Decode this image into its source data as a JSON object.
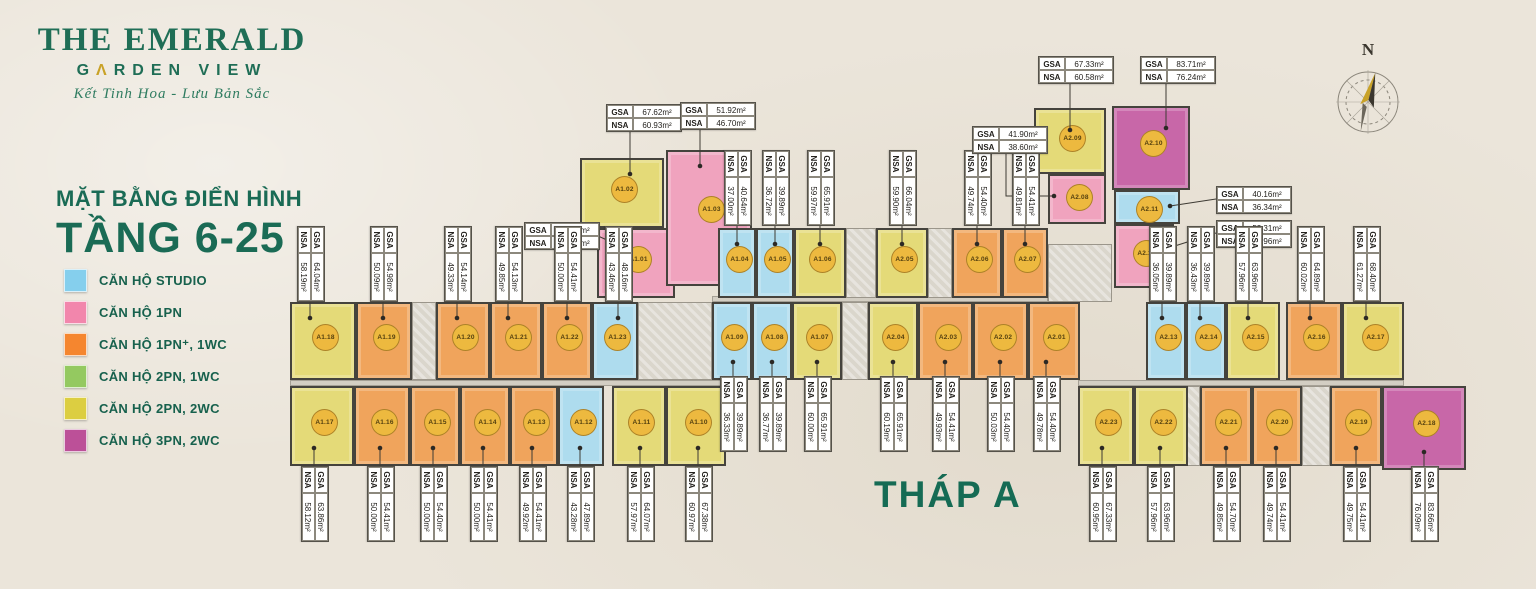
{
  "branding": {
    "line1": "THE EMERALD",
    "line2_pre": "G",
    "line2_accent": "Λ",
    "line2_rest": "RDEN VIEW",
    "tagline": "Kết Tinh Hoa - Lưu Bản Sắc"
  },
  "heading": {
    "line1": "MẶT BẰNG  ĐIỂN HÌNH",
    "line2": "TẦNG 6-25"
  },
  "tower_label": "THÁP A",
  "compass_letter": "N",
  "area_labels": {
    "gsa": "GSA",
    "nsa": "NSA"
  },
  "colors": {
    "wall": "#45433D",
    "badge": "#EDB93F",
    "leader": "#3E3B34",
    "fills": {
      "studio": "#AEDCEE",
      "pn1": "#F0A3BE",
      "pn1p": "#F0A45C",
      "pn2_1wc": "#A5CE6F",
      "pn2_2wc": "#E4DA78",
      "pn3_2wc": "#C867A8"
    }
  },
  "legend": [
    {
      "type": "studio",
      "color": "#85CFED",
      "label": "CĂN HỘ STUDIO"
    },
    {
      "type": "pn1",
      "color": "#F286AC",
      "label": "CĂN HỘ 1PN"
    },
    {
      "type": "pn1p",
      "color": "#F5862F",
      "label": "CĂN HỘ 1PN⁺, 1WC"
    },
    {
      "type": "pn2_1wc",
      "color": "#94C960",
      "label": "CĂN HỘ 2PN, 1WC"
    },
    {
      "type": "pn2_2wc",
      "color": "#DCCE41",
      "label": "CĂN HỘ 2PN, 2WC"
    },
    {
      "type": "pn3_2wc",
      "color": "#BC5098",
      "label": "CĂN HỘ 3PN, 2WC"
    }
  ],
  "units": [
    {
      "id": "A1.01",
      "type": "pn1",
      "x": 597,
      "y": 228,
      "w": 78,
      "h": 70,
      "gsa": "52.31m²",
      "nsa": "46.87m²",
      "label": {
        "kind": "h",
        "bx": 524,
        "by": 222,
        "leader": [
          [
            598,
            236
          ],
          [
            616,
            244
          ]
        ]
      }
    },
    {
      "id": "A1.02",
      "type": "pn2_2wc",
      "x": 580,
      "y": 158,
      "w": 84,
      "h": 70,
      "gsa": "67.62m²",
      "nsa": "60.93m²",
      "label": {
        "kind": "h",
        "bx": 606,
        "by": 104,
        "leader": [
          [
            630,
            131
          ],
          [
            630,
            174
          ]
        ]
      }
    },
    {
      "id": "A1.03",
      "type": "pn1",
      "x": 666,
      "y": 150,
      "w": 86,
      "h": 136,
      "gsa": "51.92m²",
      "nsa": "46.70m²",
      "label": {
        "kind": "h",
        "bx": 680,
        "by": 102,
        "leader": [
          [
            700,
            129
          ],
          [
            700,
            166
          ]
        ]
      }
    },
    {
      "id": "A1.04",
      "type": "studio",
      "x": 718,
      "y": 228,
      "w": 38,
      "h": 70,
      "gsa": "40.64m²",
      "nsa": "37.00m²",
      "label": {
        "kind": "v",
        "cx": 737,
        "cy": 188,
        "side": "top"
      }
    },
    {
      "id": "A1.05",
      "type": "studio",
      "x": 756,
      "y": 228,
      "w": 38,
      "h": 70,
      "gsa": "39.89m²",
      "nsa": "36.72m²",
      "label": {
        "kind": "v",
        "cx": 775,
        "cy": 188,
        "side": "top"
      }
    },
    {
      "id": "A1.06",
      "type": "pn2_2wc",
      "x": 794,
      "y": 228,
      "w": 52,
      "h": 70,
      "gsa": "65.91m²",
      "nsa": "59.97m²",
      "label": {
        "kind": "v",
        "cx": 820,
        "cy": 188,
        "side": "top"
      }
    },
    {
      "id": "A1.07",
      "type": "pn2_2wc",
      "x": 792,
      "y": 302,
      "w": 50,
      "h": 78,
      "gsa": "65.91m²",
      "nsa": "60.00m²",
      "label": {
        "kind": "v",
        "cx": 817,
        "cy": 414,
        "side": "bottom"
      }
    },
    {
      "id": "A1.08",
      "type": "studio",
      "x": 752,
      "y": 302,
      "w": 40,
      "h": 78,
      "gsa": "39.89m²",
      "nsa": "36.77m²",
      "label": {
        "kind": "v",
        "cx": 772,
        "cy": 414,
        "side": "bottom"
      }
    },
    {
      "id": "A1.09",
      "type": "studio",
      "x": 712,
      "y": 302,
      "w": 40,
      "h": 78,
      "gsa": "39.89m²",
      "nsa": "36.33m²",
      "label": {
        "kind": "v",
        "cx": 733,
        "cy": 414,
        "side": "bottom"
      }
    },
    {
      "id": "A1.10",
      "type": "pn2_2wc",
      "x": 666,
      "y": 386,
      "w": 60,
      "h": 80,
      "gsa": "67.38m²",
      "nsa": "60.97m²",
      "label": {
        "kind": "v",
        "cx": 698,
        "cy": 504,
        "side": "bottom"
      }
    },
    {
      "id": "A1.11",
      "type": "pn2_2wc",
      "x": 612,
      "y": 386,
      "w": 54,
      "h": 80,
      "gsa": "64.07m²",
      "nsa": "57.97m²",
      "label": {
        "kind": "v",
        "cx": 640,
        "cy": 504,
        "side": "bottom"
      }
    },
    {
      "id": "A1.12",
      "type": "studio",
      "x": 558,
      "y": 386,
      "w": 46,
      "h": 80,
      "gsa": "47.89m²",
      "nsa": "43.28m²",
      "label": {
        "kind": "v",
        "cx": 580,
        "cy": 504,
        "side": "bottom"
      }
    },
    {
      "id": "A1.13",
      "type": "pn1p",
      "x": 510,
      "y": 386,
      "w": 48,
      "h": 80,
      "gsa": "54.41m²",
      "nsa": "49.92m²",
      "label": {
        "kind": "v",
        "cx": 532,
        "cy": 504,
        "side": "bottom"
      }
    },
    {
      "id": "A1.14",
      "type": "pn1p",
      "x": 460,
      "y": 386,
      "w": 50,
      "h": 80,
      "gsa": "54.41m²",
      "nsa": "50.00m²",
      "label": {
        "kind": "v",
        "cx": 483,
        "cy": 504,
        "side": "bottom"
      }
    },
    {
      "id": "A1.15",
      "type": "pn1p",
      "x": 410,
      "y": 386,
      "w": 50,
      "h": 80,
      "gsa": "54.40m²",
      "nsa": "50.00m²",
      "label": {
        "kind": "v",
        "cx": 433,
        "cy": 504,
        "side": "bottom"
      }
    },
    {
      "id": "A1.16",
      "type": "pn1p",
      "x": 354,
      "y": 386,
      "w": 56,
      "h": 80,
      "gsa": "54.41m²",
      "nsa": "50.00m²",
      "label": {
        "kind": "v",
        "cx": 380,
        "cy": 504,
        "side": "bottom"
      }
    },
    {
      "id": "A1.17",
      "type": "pn2_2wc",
      "x": 290,
      "y": 386,
      "w": 64,
      "h": 80,
      "gsa": "63.86m²",
      "nsa": "58.12m²",
      "label": {
        "kind": "v",
        "cx": 314,
        "cy": 504,
        "side": "bottom"
      }
    },
    {
      "id": "A1.18",
      "type": "pn2_2wc",
      "x": 290,
      "y": 302,
      "w": 66,
      "h": 78,
      "gsa": "64.04m²",
      "nsa": "58.19m²",
      "label": {
        "kind": "v",
        "cx": 310,
        "cy": 264,
        "side": "top"
      }
    },
    {
      "id": "A1.19",
      "type": "pn1p",
      "x": 356,
      "y": 302,
      "w": 56,
      "h": 78,
      "gsa": "54.98m²",
      "nsa": "50.09m²",
      "label": {
        "kind": "v",
        "cx": 383,
        "cy": 264,
        "side": "top"
      }
    },
    {
      "id": "A1.20",
      "type": "pn1p",
      "x": 436,
      "y": 302,
      "w": 54,
      "h": 78,
      "gsa": "54.14m²",
      "nsa": "49.33m²",
      "label": {
        "kind": "v",
        "cx": 457,
        "cy": 264,
        "side": "top"
      }
    },
    {
      "id": "A1.21",
      "type": "pn1p",
      "x": 490,
      "y": 302,
      "w": 52,
      "h": 78,
      "gsa": "54.13m²",
      "nsa": "49.85m²",
      "label": {
        "kind": "v",
        "cx": 508,
        "cy": 264,
        "side": "top"
      }
    },
    {
      "id": "A1.22",
      "type": "pn1p",
      "x": 542,
      "y": 302,
      "w": 50,
      "h": 78,
      "gsa": "54.41m²",
      "nsa": "50.00m²",
      "label": {
        "kind": "v",
        "cx": 567,
        "cy": 264,
        "side": "top"
      }
    },
    {
      "id": "A1.23",
      "type": "studio",
      "x": 592,
      "y": 302,
      "w": 46,
      "h": 78,
      "gsa": "48.16m²",
      "nsa": "43.46m²",
      "label": {
        "kind": "v",
        "cx": 618,
        "cy": 264,
        "side": "top"
      }
    },
    {
      "id": "A2.01",
      "type": "pn1p",
      "x": 1028,
      "y": 302,
      "w": 52,
      "h": 78,
      "gsa": "54.40m²",
      "nsa": "49.78m²",
      "label": {
        "kind": "v",
        "cx": 1046,
        "cy": 414,
        "side": "bottom"
      }
    },
    {
      "id": "A2.02",
      "type": "pn1p",
      "x": 973,
      "y": 302,
      "w": 55,
      "h": 78,
      "gsa": "54.40m²",
      "nsa": "50.03m²",
      "label": {
        "kind": "v",
        "cx": 1000,
        "cy": 414,
        "side": "bottom"
      }
    },
    {
      "id": "A2.03",
      "type": "pn1p",
      "x": 918,
      "y": 302,
      "w": 55,
      "h": 78,
      "gsa": "54.41m²",
      "nsa": "49.93m²",
      "label": {
        "kind": "v",
        "cx": 945,
        "cy": 414,
        "side": "bottom"
      }
    },
    {
      "id": "A2.04",
      "type": "pn2_2wc",
      "x": 868,
      "y": 302,
      "w": 50,
      "h": 78,
      "gsa": "65.91m²",
      "nsa": "60.19m²",
      "label": {
        "kind": "v",
        "cx": 893,
        "cy": 414,
        "side": "bottom"
      }
    },
    {
      "id": "A2.05",
      "type": "pn2_2wc",
      "x": 876,
      "y": 228,
      "w": 52,
      "h": 70,
      "gsa": "66.04m²",
      "nsa": "59.90m²",
      "label": {
        "kind": "v",
        "cx": 902,
        "cy": 188,
        "side": "top"
      }
    },
    {
      "id": "A2.06",
      "type": "pn1p",
      "x": 952,
      "y": 228,
      "w": 50,
      "h": 70,
      "gsa": "54.40m²",
      "nsa": "49.74m²",
      "label": {
        "kind": "v",
        "cx": 977,
        "cy": 188,
        "side": "top"
      }
    },
    {
      "id": "A2.07",
      "type": "pn1p",
      "x": 1002,
      "y": 228,
      "w": 46,
      "h": 70,
      "gsa": "54.41m²",
      "nsa": "49.81m²",
      "label": {
        "kind": "v",
        "cx": 1025,
        "cy": 188,
        "side": "top"
      }
    },
    {
      "id": "A2.08",
      "type": "pn1",
      "x": 1048,
      "y": 174,
      "w": 58,
      "h": 50,
      "gsa": "41.90m²",
      "nsa": "38.60m²",
      "label": {
        "kind": "h",
        "bx": 972,
        "by": 126,
        "leader": [
          [
            1006,
            153
          ],
          [
            1006,
            196
          ],
          [
            1054,
            196
          ]
        ]
      }
    },
    {
      "id": "A2.09",
      "type": "pn2_2wc",
      "x": 1034,
      "y": 108,
      "w": 72,
      "h": 66,
      "gsa": "67.33m²",
      "nsa": "60.58m²",
      "label": {
        "kind": "h",
        "bx": 1038,
        "by": 56,
        "leader": [
          [
            1070,
            83
          ],
          [
            1070,
            130
          ]
        ]
      }
    },
    {
      "id": "A2.10",
      "type": "pn3_2wc",
      "x": 1112,
      "y": 106,
      "w": 78,
      "h": 84,
      "gsa": "83.71m²",
      "nsa": "76.24m²",
      "label": {
        "kind": "h",
        "bx": 1140,
        "by": 56,
        "leader": [
          [
            1166,
            83
          ],
          [
            1166,
            128
          ]
        ]
      }
    },
    {
      "id": "A2.11",
      "type": "studio",
      "x": 1114,
      "y": 190,
      "w": 66,
      "h": 34,
      "gsa": "40.16m²",
      "nsa": "36.34m²",
      "label": {
        "kind": "h",
        "bx": 1216,
        "by": 186,
        "leader": [
          [
            1216,
            199
          ],
          [
            1170,
            206
          ]
        ]
      }
    },
    {
      "id": "A2.12",
      "type": "pn1",
      "x": 1114,
      "y": 224,
      "w": 60,
      "h": 64,
      "gsa": "52.31m²",
      "nsa": "46.96m²",
      "label": {
        "kind": "h",
        "bx": 1216,
        "by": 220,
        "leader": [
          [
            1216,
            233
          ],
          [
            1162,
            250
          ]
        ]
      }
    },
    {
      "id": "A2.13",
      "type": "studio",
      "x": 1146,
      "y": 302,
      "w": 40,
      "h": 78,
      "gsa": "39.89m²",
      "nsa": "36.05m²",
      "label": {
        "kind": "v",
        "cx": 1162,
        "cy": 264,
        "side": "top"
      }
    },
    {
      "id": "A2.14",
      "type": "studio",
      "x": 1186,
      "y": 302,
      "w": 40,
      "h": 78,
      "gsa": "39.89m²",
      "nsa": "36.43m²",
      "label": {
        "kind": "v",
        "cx": 1200,
        "cy": 264,
        "side": "top"
      }
    },
    {
      "id": "A2.15",
      "type": "pn2_2wc",
      "x": 1226,
      "y": 302,
      "w": 54,
      "h": 78,
      "gsa": "63.96m²",
      "nsa": "57.96m²",
      "label": {
        "kind": "v",
        "cx": 1248,
        "cy": 264,
        "side": "top"
      }
    },
    {
      "id": "A2.16",
      "type": "pn1p",
      "x": 1286,
      "y": 302,
      "w": 56,
      "h": 78,
      "gsa": "64.89m²",
      "nsa": "60.02m²",
      "label": {
        "kind": "v",
        "cx": 1310,
        "cy": 264,
        "side": "top"
      }
    },
    {
      "id": "A2.17",
      "type": "pn2_2wc",
      "x": 1342,
      "y": 302,
      "w": 62,
      "h": 78,
      "gsa": "68.40m²",
      "nsa": "61.27m²",
      "label": {
        "kind": "v",
        "cx": 1366,
        "cy": 264,
        "side": "top"
      }
    },
    {
      "id": "A2.18",
      "type": "pn3_2wc",
      "x": 1382,
      "y": 386,
      "w": 84,
      "h": 84,
      "gsa": "83.66m²",
      "nsa": "76.09m²",
      "label": {
        "kind": "v",
        "cx": 1424,
        "cy": 504,
        "side": "bottom"
      }
    },
    {
      "id": "A2.19",
      "type": "pn1p",
      "x": 1330,
      "y": 386,
      "w": 52,
      "h": 80,
      "gsa": "54.41m²",
      "nsa": "49.75m²",
      "label": {
        "kind": "v",
        "cx": 1356,
        "cy": 504,
        "side": "bottom"
      }
    },
    {
      "id": "A2.20",
      "type": "pn1p",
      "x": 1252,
      "y": 386,
      "w": 50,
      "h": 80,
      "gsa": "54.41m²",
      "nsa": "49.74m²",
      "label": {
        "kind": "v",
        "cx": 1276,
        "cy": 504,
        "side": "bottom"
      }
    },
    {
      "id": "A2.21",
      "type": "pn1p",
      "x": 1200,
      "y": 386,
      "w": 52,
      "h": 80,
      "gsa": "54.70m²",
      "nsa": "49.85m²",
      "label": {
        "kind": "v",
        "cx": 1226,
        "cy": 504,
        "side": "bottom"
      }
    },
    {
      "id": "A2.22",
      "type": "pn2_2wc",
      "x": 1134,
      "y": 386,
      "w": 54,
      "h": 80,
      "gsa": "63.96m²",
      "nsa": "57.96m²",
      "label": {
        "kind": "v",
        "cx": 1160,
        "cy": 504,
        "side": "bottom"
      }
    },
    {
      "id": "A2.23",
      "type": "pn2_2wc",
      "x": 1078,
      "y": 386,
      "w": 56,
      "h": 80,
      "gsa": "67.33m²",
      "nsa": "60.95m²",
      "label": {
        "kind": "v",
        "cx": 1102,
        "cy": 504,
        "side": "bottom"
      }
    }
  ],
  "cores": [
    {
      "x": 412,
      "y": 302,
      "w": 24,
      "h": 78
    },
    {
      "x": 638,
      "y": 302,
      "w": 74,
      "h": 78
    },
    {
      "x": 842,
      "y": 302,
      "w": 26,
      "h": 78
    },
    {
      "x": 846,
      "y": 228,
      "w": 30,
      "h": 70
    },
    {
      "x": 928,
      "y": 228,
      "w": 24,
      "h": 70
    },
    {
      "x": 1048,
      "y": 244,
      "w": 64,
      "h": 58
    },
    {
      "x": 1186,
      "y": 386,
      "w": 14,
      "h": 80
    },
    {
      "x": 1302,
      "y": 386,
      "w": 28,
      "h": 80
    }
  ],
  "corridors": [
    {
      "x": 290,
      "y": 380,
      "w": 448,
      "h": 6
    },
    {
      "x": 1078,
      "y": 380,
      "w": 326,
      "h": 6
    },
    {
      "x": 712,
      "y": 296,
      "w": 336,
      "h": 6
    }
  ]
}
